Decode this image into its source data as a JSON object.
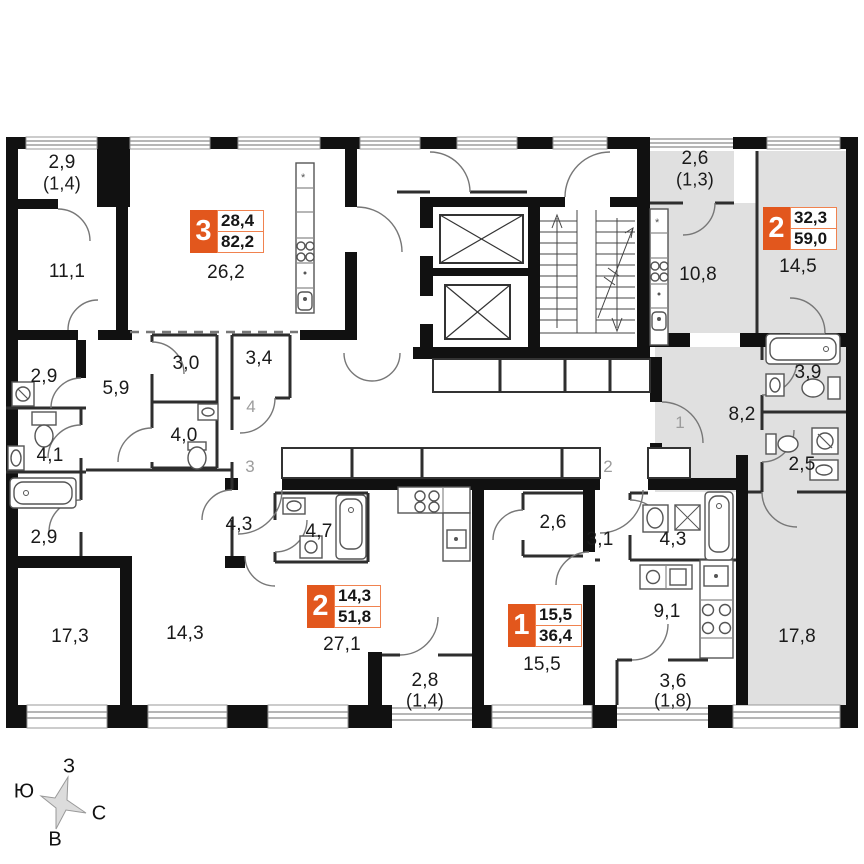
{
  "plan": {
    "apartments": [
      {
        "rooms": "3",
        "living_area": "28,4",
        "total_area": "82,2"
      },
      {
        "rooms": "2",
        "living_area": "32,3",
        "total_area": "59,0"
      },
      {
        "rooms": "2",
        "living_area": "14,3",
        "total_area": "51,8"
      },
      {
        "rooms": "1",
        "living_area": "15,5",
        "total_area": "36,4"
      }
    ],
    "room_labels": [
      {
        "text": "2,9",
        "sub": "(1,4)"
      },
      {
        "text": "11,1"
      },
      {
        "text": "26,2"
      },
      {
        "text": "3,0"
      },
      {
        "text": "3,4"
      },
      {
        "text": "2,9"
      },
      {
        "text": "5,9"
      },
      {
        "text": "4,0"
      },
      {
        "text": "4,1"
      },
      {
        "text": "2,9"
      },
      {
        "text": "4,3"
      },
      {
        "text": "17,3"
      },
      {
        "text": "14,3"
      },
      {
        "text": "4,7"
      },
      {
        "text": "27,1"
      },
      {
        "text": "2,8",
        "sub": "(1,4)"
      },
      {
        "text": "2,6"
      },
      {
        "text": "15,5"
      },
      {
        "text": "3,1"
      },
      {
        "text": "4,3"
      },
      {
        "text": "9,1"
      },
      {
        "text": "3,6",
        "sub": "(1,8)"
      },
      {
        "text": "17,8"
      },
      {
        "text": "8,2"
      },
      {
        "text": "2,5"
      },
      {
        "text": "3,9"
      },
      {
        "text": "14,5"
      },
      {
        "text": "10,8"
      },
      {
        "text": "2,6",
        "sub": "(1,3)"
      }
    ],
    "unit_numbers": [
      "4",
      "3",
      "2",
      "1"
    ],
    "compass": {
      "top": "З",
      "left": "Ю",
      "right": "С",
      "bottom": "В"
    },
    "colors": {
      "accent_orange": "#e2571d",
      "highlight_gray": "#e0e0e0",
      "wall_black": "#111111"
    }
  }
}
